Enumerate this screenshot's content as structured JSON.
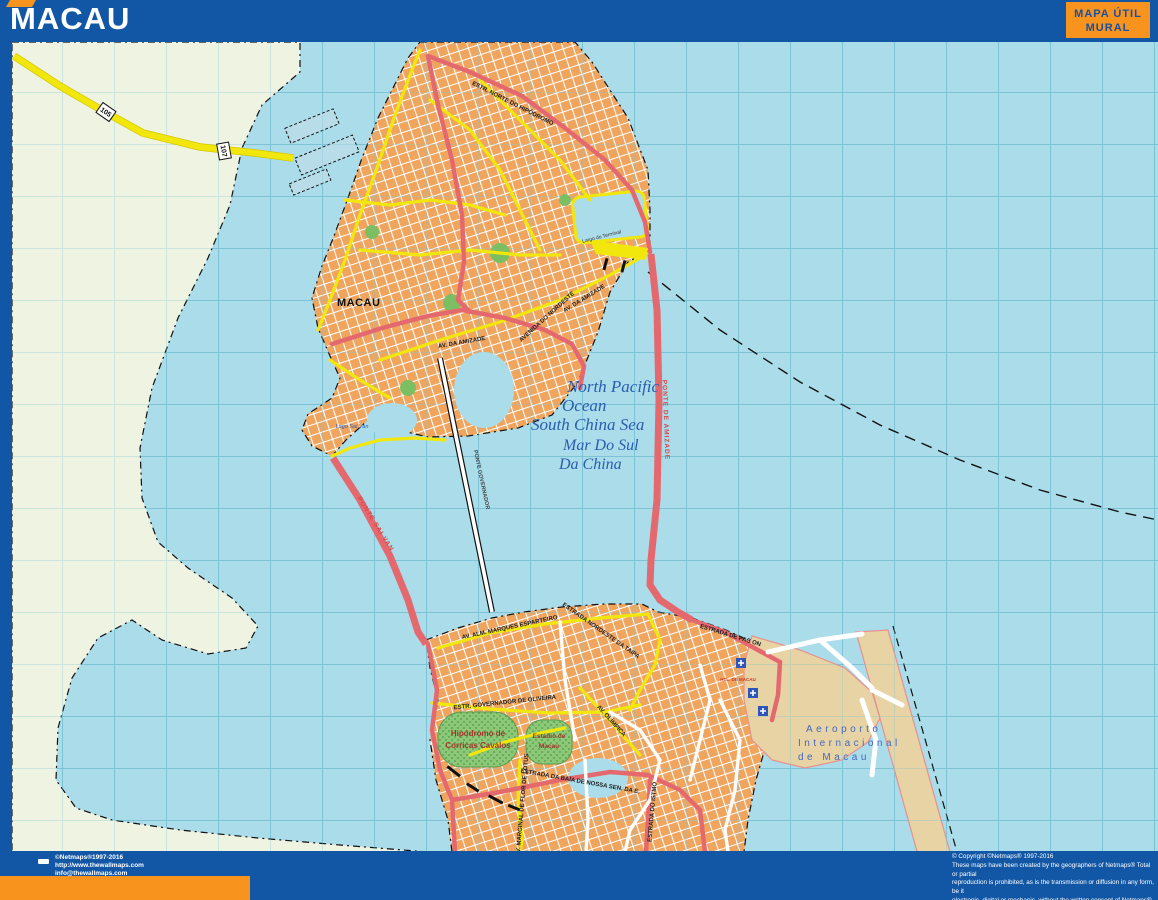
{
  "header": {
    "title": "MACAU",
    "brand_line1": "MAPA ÚTIL",
    "brand_line2": "MURAL"
  },
  "colors": {
    "header_blue": "#1257a5",
    "accent_orange": "#f8941e",
    "water_blue": "#aadcea",
    "grid_teal": "#7cc3d6",
    "land_cream": "#eef3e2",
    "urban_orange": "#f0a55f",
    "road_yellow": "#f2e70c",
    "road_red": "#e4696e",
    "park_green": "#8cc878",
    "runway_tan": "#e7d3a3",
    "ocean_label_blue": "#2a5db0"
  },
  "map": {
    "city": "MACAU",
    "ocean": {
      "line1": "North Pacific",
      "line2": "Ocean",
      "line3": "South China Sea",
      "line4": "Mar Do Sul",
      "line5": "Da China"
    },
    "bridges": {
      "amizade": "PONTE DE AMIZADE",
      "sai_van": "PONTE SAI VAN",
      "governador": "PONTE GOVERNADOR"
    },
    "shields": [
      "105",
      "107"
    ],
    "roads": {
      "estr_norte": "ESTR. NORTE DO HIPÓDROMO",
      "av_nordeste": "AVENIDA DO NORDESTE",
      "av_amizade": "AV. DA AMIZADE",
      "av_amizade2": "AV. DA AMIZADE",
      "marques_esparteiro": "AV. ALM. MARQUES ESPARTEIRO",
      "nordeste_taipa": "ESTRADA NORDESTE DA TAIPA",
      "pac_on": "ESTRADA DE PAC ON",
      "gov_oliveira": "ESTR. GOVERNADOR DE OLIVEIRA",
      "olimpica": "AV. OLÍMPICA",
      "baia_nossa": "ESTRADA DA BAÍA DE NOSSA SEN. DA E.",
      "istmo": "ESTRADA DO ISTMO",
      "marginal": "AV. MARGINAL DE FLOR DE LOTUS"
    },
    "places": {
      "lago_sai_van": "Lago Sai Van",
      "largo_terminal": "Largo do Terminal",
      "hotel": "HTL. DE MACAU",
      "hipodromo_l1": "Hipódromo de",
      "hipodromo_l2": "Corricas Cavalos",
      "estadio_l1": "Estádio de",
      "estadio_l2": "Macau",
      "airport_l1": "Aeroporto",
      "airport_l2": "Internacional",
      "airport_l3": "de Macau"
    }
  },
  "footer": {
    "left_lines": [
      "©Netmaps®1997-2016",
      "http://www.thewallmaps.com",
      "info@thewallmaps.com"
    ],
    "right_lines": [
      "© Copyright ©Netmaps® 1997-2016",
      "These maps have been created by the geographers of Netmaps® Total or partial",
      "reproduction is prohibited, as is the transmission or diffusion in any form, be it",
      "electronic, digital or mechanic, without the written consent of Netmaps®",
      "For more information consult: www.thewallmaps.com"
    ]
  }
}
